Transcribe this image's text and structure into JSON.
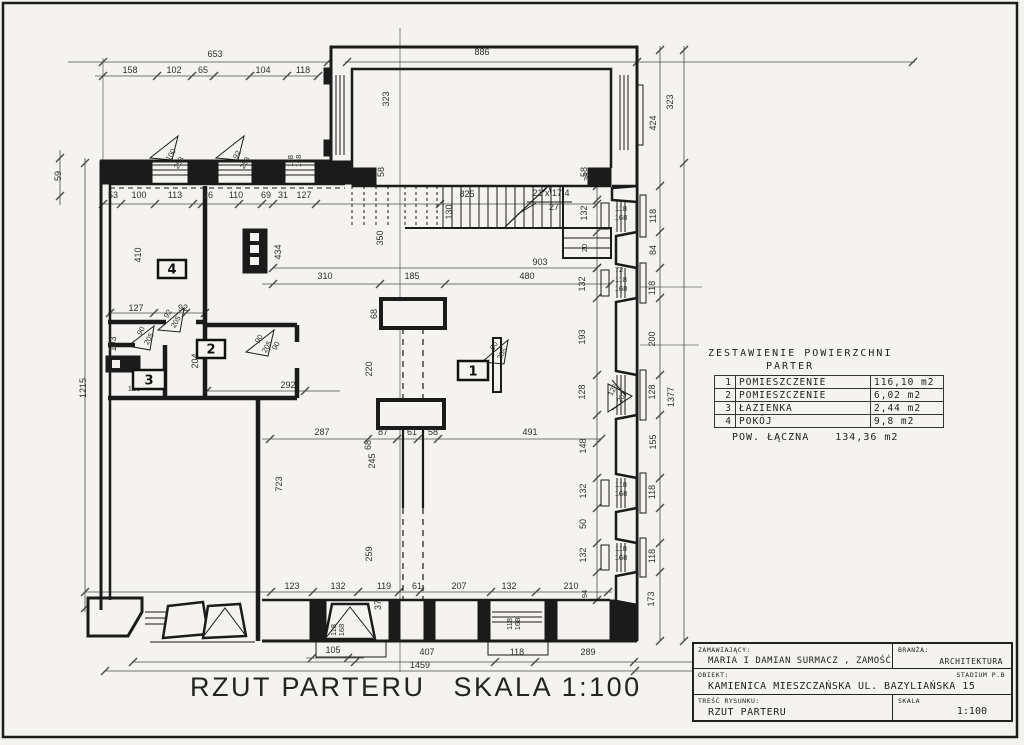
{
  "caption": {
    "title": "RZUT PARTERU",
    "scale": "SKALA 1:100"
  },
  "area_table": {
    "title": "ZESTAWIENIE POWIERZCHNI",
    "subtitle": "PARTER",
    "rows": [
      {
        "no": "1",
        "name": "POMIESZCZENIE",
        "area": "116,10 m2"
      },
      {
        "no": "2",
        "name": "POMIESZCZENIE",
        "area": "6,02 m2"
      },
      {
        "no": "3",
        "name": "ŁAZIENKA",
        "area": "2,44 m2"
      },
      {
        "no": "4",
        "name": "POKÓJ",
        "area": "9,8 m2"
      }
    ],
    "total_label": "POW. ŁĄCZNA",
    "total_value": "134,36 m2"
  },
  "title_block": {
    "client_label": "ZAMAWIAJĄCY:",
    "client": "MARIA I DAMIAN SURMACZ , ZAMOŚĆ",
    "branch_label": "BRANŻA:",
    "branch": "ARCHITEKTURA",
    "object_label": "OBIEKT:",
    "object": "KAMIENICA MIESZCZAŃSKA UL. BAZYLIAŃSKA 15",
    "stage": "STADIUM P.B",
    "drawing_label": "TREŚĆ RYSUNKU:",
    "drawing": "RZUT PARTERU",
    "scale_label": "SKALA",
    "scale": "1:100"
  },
  "stair_note": {
    "line1": "21 x 17.4",
    "line2": "27"
  },
  "room_labels": [
    {
      "n": "1",
      "x": 458,
      "y": 361,
      "w": 30,
      "h": 19
    },
    {
      "n": "2",
      "x": 197,
      "y": 340,
      "w": 28,
      "h": 18
    },
    {
      "n": "3",
      "x": 133,
      "y": 370,
      "w": 32,
      "h": 19
    },
    {
      "n": "4",
      "x": 158,
      "y": 260,
      "w": 28,
      "h": 18
    }
  ],
  "dim_labels": [
    {
      "t": "653",
      "x": 215,
      "y": 57
    },
    {
      "t": "158",
      "x": 130,
      "y": 73
    },
    {
      "t": "102",
      "x": 174,
      "y": 73
    },
    {
      "t": "65",
      "x": 203,
      "y": 73
    },
    {
      "t": "104",
      "x": 263,
      "y": 73
    },
    {
      "t": "118",
      "x": 303,
      "y": 73
    },
    {
      "t": "886",
      "x": 482,
      "y": 55
    },
    {
      "t": "53",
      "x": 113,
      "y": 198
    },
    {
      "t": "100",
      "x": 139,
      "y": 198
    },
    {
      "t": "113",
      "x": 175,
      "y": 198
    },
    {
      "t": "26",
      "x": 208,
      "y": 198
    },
    {
      "t": "110",
      "x": 236,
      "y": 198
    },
    {
      "t": "69",
      "x": 266,
      "y": 198
    },
    {
      "t": "31",
      "x": 283,
      "y": 198
    },
    {
      "t": "127",
      "x": 304,
      "y": 198
    },
    {
      "t": "825",
      "x": 467,
      "y": 197
    },
    {
      "t": "130",
      "x": 452,
      "y": 212,
      "r": -90
    },
    {
      "t": "21 x 17.4",
      "x": 551,
      "y": 196
    },
    {
      "t": "27",
      "x": 554,
      "y": 210
    },
    {
      "t": "323",
      "x": 389,
      "y": 99,
      "r": -90
    },
    {
      "t": "58",
      "x": 384,
      "y": 172,
      "r": -90
    },
    {
      "t": "58",
      "x": 587,
      "y": 172,
      "r": -90
    },
    {
      "t": "118",
      "x": 293,
      "y": 161,
      "r": -90,
      "s": 1
    },
    {
      "t": "168",
      "x": 301,
      "y": 161,
      "r": -90,
      "s": 1
    },
    {
      "t": "100",
      "x": 173,
      "y": 156,
      "r": -60,
      "s": 1
    },
    {
      "t": "258",
      "x": 181,
      "y": 164,
      "r": -60,
      "s": 1
    },
    {
      "t": "92",
      "x": 239,
      "y": 156,
      "r": -60,
      "s": 1
    },
    {
      "t": "258",
      "x": 247,
      "y": 164,
      "r": -60,
      "s": 1
    },
    {
      "t": "323",
      "x": 673,
      "y": 102,
      "r": -90
    },
    {
      "t": "424",
      "x": 656,
      "y": 123,
      "r": -90
    },
    {
      "t": "1377",
      "x": 674,
      "y": 397,
      "r": -90
    },
    {
      "t": "36",
      "x": 589,
      "y": 177,
      "r": -90,
      "s": 1
    },
    {
      "t": "132",
      "x": 587,
      "y": 213,
      "r": -90
    },
    {
      "t": "20",
      "x": 587,
      "y": 248,
      "r": -90,
      "s": 1
    },
    {
      "t": "132",
      "x": 585,
      "y": 284,
      "r": -90
    },
    {
      "t": "193",
      "x": 585,
      "y": 337,
      "r": -90
    },
    {
      "t": "128",
      "x": 585,
      "y": 392,
      "r": -90
    },
    {
      "t": "148",
      "x": 586,
      "y": 446,
      "r": -90
    },
    {
      "t": "132",
      "x": 586,
      "y": 491,
      "r": -90
    },
    {
      "t": "50",
      "x": 586,
      "y": 524,
      "r": -90
    },
    {
      "t": "132",
      "x": 586,
      "y": 555,
      "r": -90
    },
    {
      "t": "118",
      "x": 656,
      "y": 216,
      "r": -90
    },
    {
      "t": "84",
      "x": 656,
      "y": 250,
      "r": -90
    },
    {
      "t": "118",
      "x": 655,
      "y": 288,
      "r": -90
    },
    {
      "t": "200",
      "x": 655,
      "y": 339,
      "r": -90
    },
    {
      "t": "128",
      "x": 655,
      "y": 392,
      "r": -90
    },
    {
      "t": "155",
      "x": 656,
      "y": 442,
      "r": -90
    },
    {
      "t": "118",
      "x": 655,
      "y": 492,
      "r": -90
    },
    {
      "t": "118",
      "x": 655,
      "y": 556,
      "r": -90
    },
    {
      "t": "173",
      "x": 654,
      "y": 599,
      "r": -90
    },
    {
      "t": "72",
      "x": 619,
      "y": 272,
      "s": 1
    },
    {
      "t": "118",
      "x": 621,
      "y": 282,
      "s": 1
    },
    {
      "t": "168",
      "x": 621,
      "y": 291,
      "s": 1
    },
    {
      "t": "118",
      "x": 621,
      "y": 211,
      "s": 1
    },
    {
      "t": "168",
      "x": 621,
      "y": 220,
      "s": 1
    },
    {
      "t": "118",
      "x": 621,
      "y": 487,
      "s": 1
    },
    {
      "t": "168",
      "x": 621,
      "y": 496,
      "s": 1
    },
    {
      "t": "118",
      "x": 621,
      "y": 551,
      "s": 1
    },
    {
      "t": "168",
      "x": 621,
      "y": 560,
      "s": 1
    },
    {
      "t": "126",
      "x": 615,
      "y": 391,
      "r": -60,
      "s": 1
    },
    {
      "t": "202",
      "x": 624,
      "y": 398,
      "r": -60,
      "s": 1
    },
    {
      "t": "59",
      "x": 61,
      "y": 176,
      "r": -90
    },
    {
      "t": "1215",
      "x": 86,
      "y": 388,
      "r": -90
    },
    {
      "t": "410",
      "x": 141,
      "y": 255,
      "r": -90
    },
    {
      "t": "434",
      "x": 281,
      "y": 252,
      "r": -90
    },
    {
      "t": "350",
      "x": 383,
      "y": 238,
      "r": -90
    },
    {
      "t": "127",
      "x": 136,
      "y": 311
    },
    {
      "t": "92",
      "x": 183,
      "y": 311
    },
    {
      "t": "103",
      "x": 116,
      "y": 344,
      "r": -90
    },
    {
      "t": "204",
      "x": 198,
      "y": 361,
      "r": -90
    },
    {
      "t": "292",
      "x": 288,
      "y": 388
    },
    {
      "t": "120",
      "x": 134,
      "y": 391,
      "s": 1
    },
    {
      "t": "92",
      "x": 170,
      "y": 315,
      "r": -60,
      "s": 1
    },
    {
      "t": "205",
      "x": 178,
      "y": 323,
      "r": -60,
      "s": 1
    },
    {
      "t": "90",
      "x": 143,
      "y": 332,
      "r": -60,
      "s": 1
    },
    {
      "t": "205",
      "x": 151,
      "y": 340,
      "r": -60,
      "s": 1
    },
    {
      "t": "90",
      "x": 261,
      "y": 340,
      "r": -60,
      "s": 1
    },
    {
      "t": "205",
      "x": 269,
      "y": 348,
      "r": -60,
      "s": 1
    },
    {
      "t": "90",
      "x": 278,
      "y": 347,
      "r": -60,
      "s": 1
    },
    {
      "t": "90",
      "x": 496,
      "y": 347,
      "r": -60,
      "s": 1
    },
    {
      "t": "205",
      "x": 504,
      "y": 355,
      "r": -60,
      "s": 1
    },
    {
      "t": "903",
      "x": 540,
      "y": 265
    },
    {
      "t": "310",
      "x": 325,
      "y": 279
    },
    {
      "t": "185",
      "x": 412,
      "y": 279
    },
    {
      "t": "480",
      "x": 527,
      "y": 279
    },
    {
      "t": "68",
      "x": 377,
      "y": 314,
      "r": -90
    },
    {
      "t": "68",
      "x": 371,
      "y": 445,
      "r": -90
    },
    {
      "t": "220",
      "x": 372,
      "y": 369,
      "r": -90
    },
    {
      "t": "245",
      "x": 375,
      "y": 461,
      "r": -90
    },
    {
      "t": "259",
      "x": 372,
      "y": 554,
      "r": -90
    },
    {
      "t": "723",
      "x": 282,
      "y": 484,
      "r": -90
    },
    {
      "t": "287",
      "x": 322,
      "y": 435
    },
    {
      "t": "87",
      "x": 383,
      "y": 435
    },
    {
      "t": "61",
      "x": 412,
      "y": 435
    },
    {
      "t": "58",
      "x": 433,
      "y": 435
    },
    {
      "t": "491",
      "x": 530,
      "y": 435
    },
    {
      "t": "123",
      "x": 292,
      "y": 589
    },
    {
      "t": "132",
      "x": 338,
      "y": 589
    },
    {
      "t": "119",
      "x": 384,
      "y": 589
    },
    {
      "t": "61",
      "x": 417,
      "y": 589
    },
    {
      "t": "207",
      "x": 459,
      "y": 589
    },
    {
      "t": "132",
      "x": 509,
      "y": 589
    },
    {
      "t": "210",
      "x": 571,
      "y": 589
    },
    {
      "t": "94",
      "x": 587,
      "y": 594,
      "r": -90,
      "s": 1
    },
    {
      "t": "37",
      "x": 381,
      "y": 605,
      "r": -90
    },
    {
      "t": "118",
      "x": 336,
      "y": 630,
      "r": -90,
      "s": 1
    },
    {
      "t": "168",
      "x": 344,
      "y": 630,
      "r": -90,
      "s": 1
    },
    {
      "t": "118",
      "x": 512,
      "y": 624,
      "r": -90,
      "s": 1
    },
    {
      "t": "168",
      "x": 520,
      "y": 624,
      "r": -90,
      "s": 1
    },
    {
      "t": "105",
      "x": 333,
      "y": 653
    },
    {
      "t": "407",
      "x": 427,
      "y": 655
    },
    {
      "t": "118",
      "x": 517,
      "y": 655
    },
    {
      "t": "289",
      "x": 588,
      "y": 655
    },
    {
      "t": "1459",
      "x": 420,
      "y": 668
    }
  ],
  "colors": {
    "ink": "#1d1d1d",
    "paper": "#f4f3ef",
    "dimline": "#4a4a4a"
  }
}
